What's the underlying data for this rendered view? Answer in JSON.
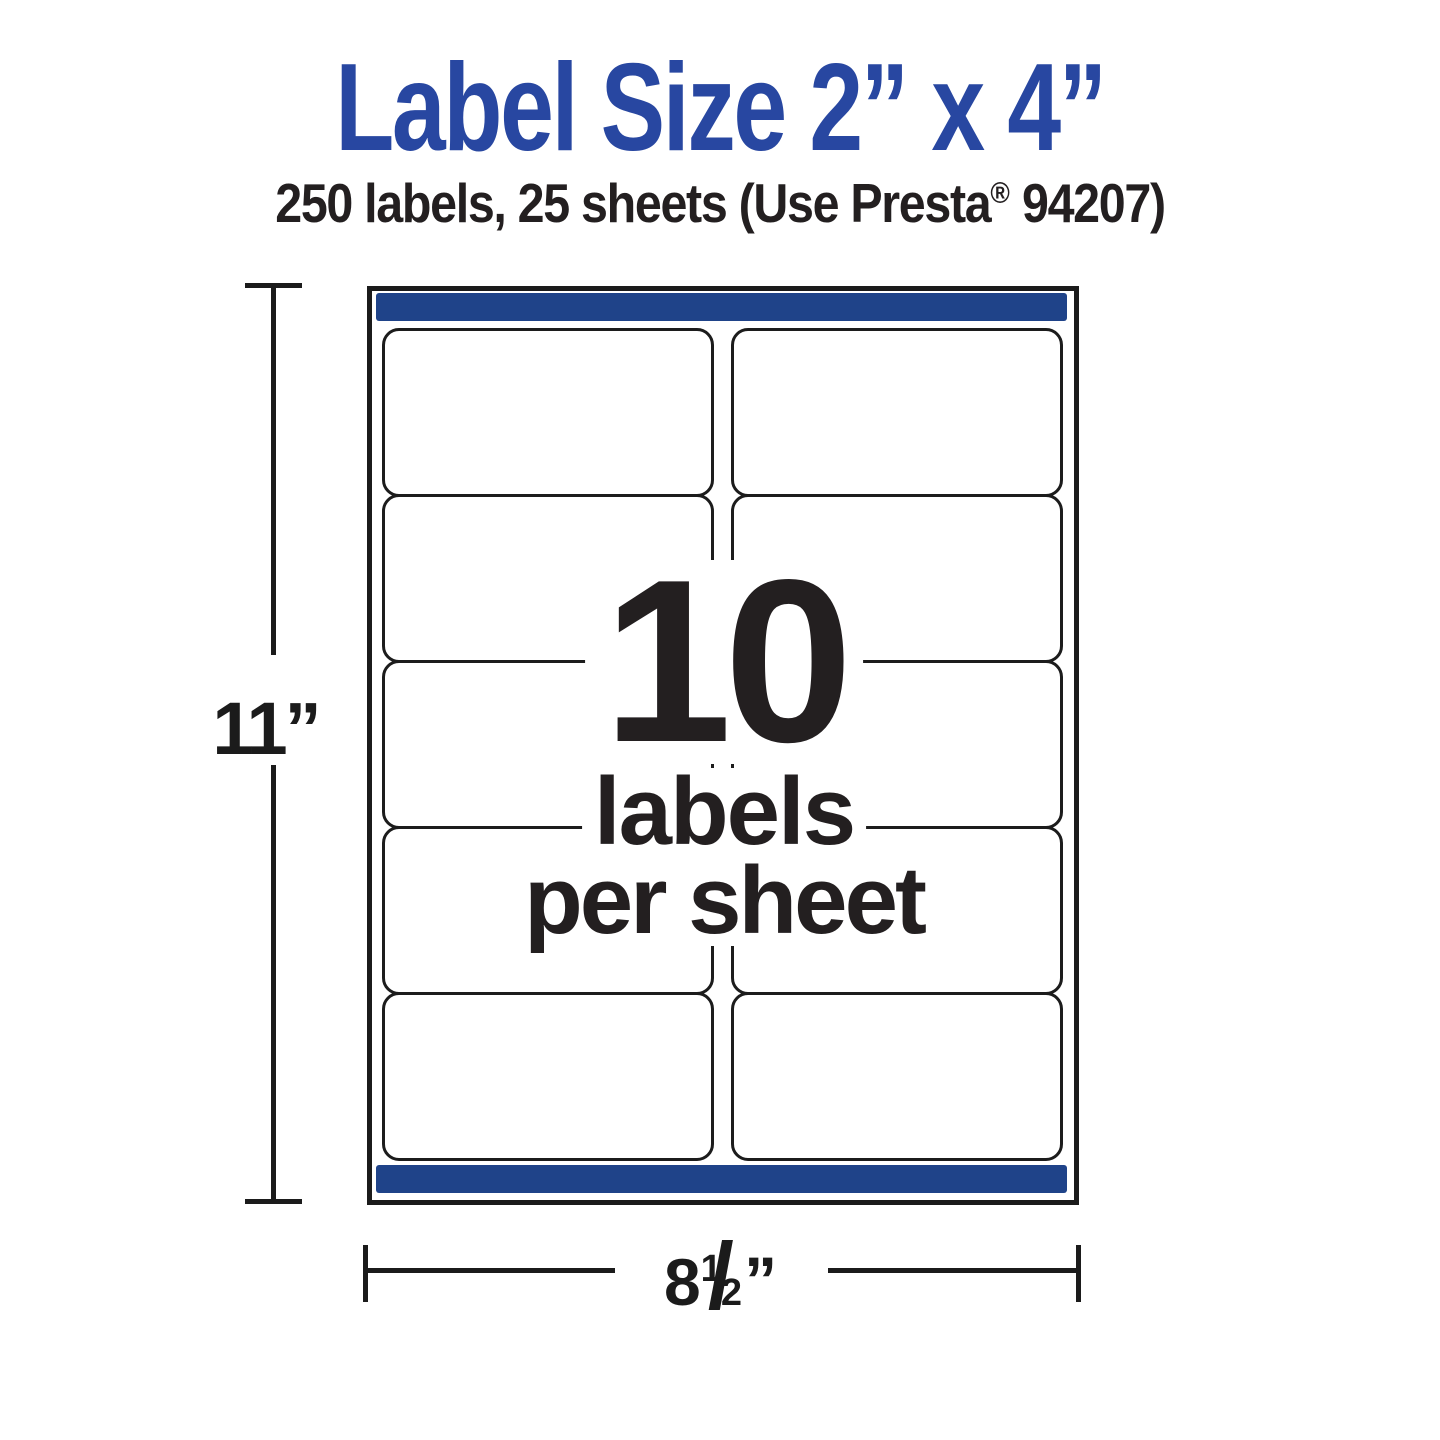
{
  "title": "Label Size 2” x 4”",
  "subtitle": {
    "before_mark": "250 labels, 25 sheets (Use Presta",
    "mark": "®",
    "after_mark": " 94207)"
  },
  "center_annotation": {
    "count": "10",
    "line2": "labels",
    "line3": "per sheet"
  },
  "dimensions": {
    "height": {
      "value": "11",
      "unit": "”"
    },
    "width": {
      "whole": "8",
      "numerator": "1",
      "slash": "/",
      "denominator": "2",
      "unit": "”"
    }
  },
  "sheet": {
    "rows": 5,
    "columns": 2,
    "labels_shown": 10
  },
  "colors": {
    "title_blue": "#2847a1",
    "bar_blue": "#1f4389",
    "ink": "#231f20",
    "line_black": "#1b1b1b"
  }
}
